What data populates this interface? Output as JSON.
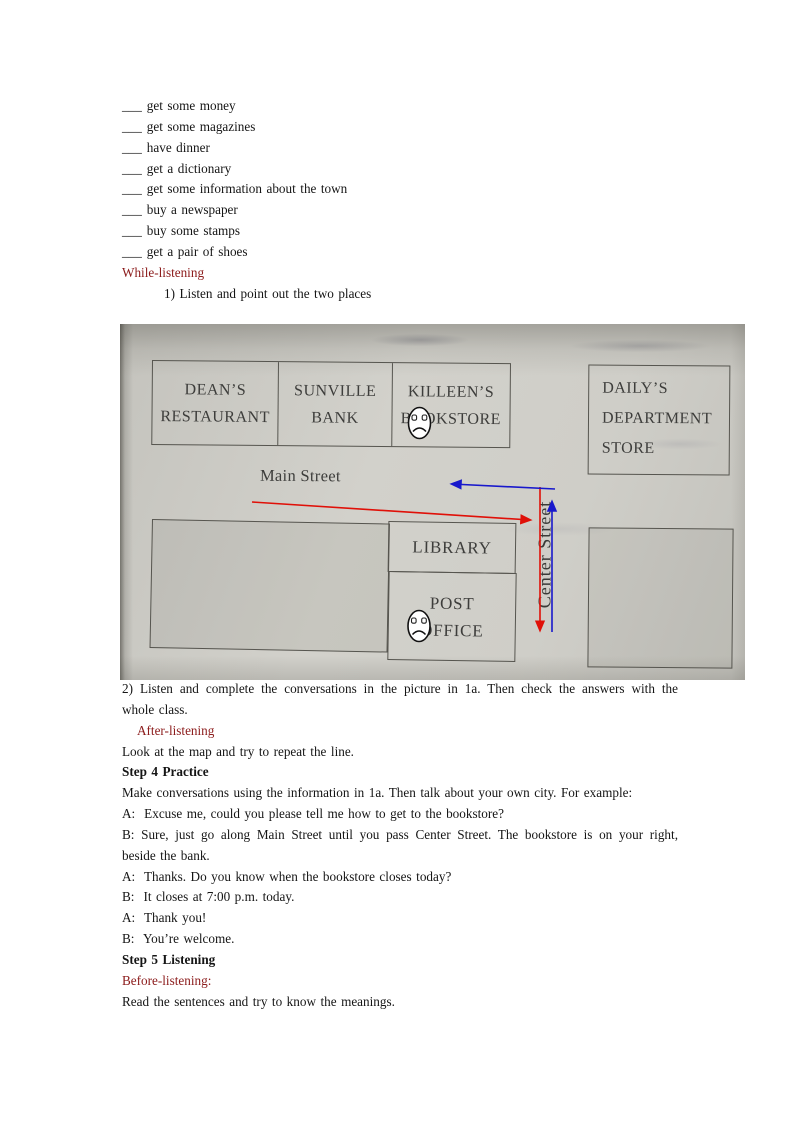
{
  "colors": {
    "heading_red": "#8B1A1A",
    "route_red": "#E01008",
    "route_blue": "#1818CC"
  },
  "checklist": {
    "blank": "___",
    "items": [
      "get some money",
      "get some magazines",
      "have dinner",
      "get a dictionary",
      "get some information about the town",
      "buy a newspaper",
      "buy some stamps",
      "get a pair of shoes"
    ]
  },
  "while_listening": {
    "heading": "While-listening",
    "task1": "1) Listen and point out the two places",
    "task2_line1": "2) Listen and complete the conversations in the picture in 1a. Then check the answers with the",
    "task2_line2": "whole class."
  },
  "map": {
    "buildings": {
      "restaurant_line1": "DEAN’S",
      "restaurant_line2": "RESTAURANT",
      "bank_line1": "SUNVILLE",
      "bank_line2": "BANK",
      "bookstore_line1": "KILLEEN’S",
      "bookstore_line2": "BOOKSTORE",
      "department_line1": "DAILY’S",
      "department_line2": "DEPARTMENT",
      "department_line3": "STORE",
      "library": "LIBRARY",
      "post_office_line1": "POST",
      "post_office_line2": "OFFICE"
    },
    "streets": {
      "main": "Main Street",
      "center": "Center Street"
    }
  },
  "after_listening": {
    "heading": "After-listening",
    "line": "Look at the map and try to repeat the line."
  },
  "step4": {
    "heading": "Step 4 Practice",
    "intro": "Make conversations using the information in 1a. Then talk about your own city. For example:",
    "dialogue": [
      "A:  Excuse me, could you please tell me how to get to the bookstore?",
      "B:  Sure, just go along Main Street until you pass Center Street. The bookstore is on your right,",
      "beside the bank.",
      "A:  Thanks. Do you know when the bookstore closes today?",
      "B:  It closes at 7:00 p.m. today.",
      "A:  Thank you!",
      "B:  You’re welcome."
    ]
  },
  "step5": {
    "heading": "Step 5 Listening",
    "before_heading": "Before-listening:",
    "line": "Read the sentences and try to know the meanings."
  }
}
